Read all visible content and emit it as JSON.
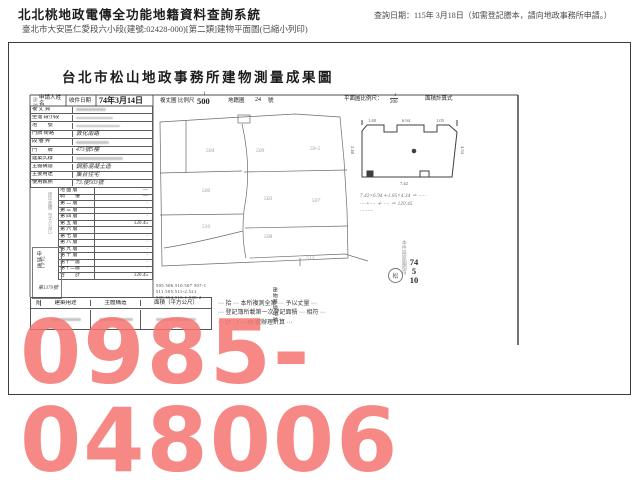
{
  "header": {
    "system_title": "北北桃地政電傳全功能地籍資料查詢系統",
    "query_date": "查詢日期：115年 3月18日（如需登記謄本，請向地政事務所申請。）",
    "doc_line": "臺北市大安區仁愛段六小段(建號:02428-000)[第二類]建物平面圖(已縮小列印)"
  },
  "survey": {
    "title": "台北市松山地政事務所建物測量成果圖",
    "margin_label": "建號",
    "top": {
      "applicant": "申請人姓名",
      "receive": "收件日期",
      "receive_date": "74年3月14日",
      "scale_label": "複丈圖 比例尺",
      "scale_num": "1",
      "scale_den": "500",
      "cadastral": "地籍圖",
      "cadastral_no": "24",
      "cadastral_unit": "號",
      "plan_scale": "平面圖比例尺：",
      "plan_num": "1",
      "plan_den": "200",
      "calc": "面積計算式"
    },
    "info_rows": [
      {
        "label": "複 丈 員",
        "value": ""
      },
      {
        "label": "坐落 段小段",
        "value": ""
      },
      {
        "label": "地　　號",
        "value": ""
      },
      {
        "label": "門牌 街路",
        "value": "敦化南路"
      },
      {
        "label": "段 巷 弄",
        "value": ""
      },
      {
        "label": "門　　牌",
        "value": "473號5樓"
      },
      {
        "label": "建築式樣",
        "value": ""
      },
      {
        "label": "主體構造",
        "value": "鋼筋混凝土造"
      },
      {
        "label": "主要用途",
        "value": "集合住宅"
      },
      {
        "label": "使用執照",
        "value": "73.使503號"
      }
    ],
    "floor_header": "建坪面積（平方公尺）",
    "floors": [
      {
        "label": "地 面 層",
        "value": "—"
      },
      {
        "label": "騎　　樓",
        "value": "—"
      },
      {
        "label": "第 二 層",
        "value": "·"
      },
      {
        "label": "第 三 層",
        "value": "·"
      },
      {
        "label": "第 四 層",
        "value": "·"
      },
      {
        "label": "第 五 層",
        "value": "120.45"
      },
      {
        "label": "第 六 層",
        "value": "·"
      },
      {
        "label": "第 七 層",
        "value": "·"
      },
      {
        "label": "第 八 層",
        "value": "·"
      },
      {
        "label": "第 九 層",
        "value": "·"
      },
      {
        "label": "第 十 層",
        "value": "·"
      },
      {
        "label": "第十一層",
        "value": "·"
      },
      {
        "label": "第十二層",
        "value": "·"
      },
      {
        "label": "合　　計",
        "value": "120.45"
      }
    ],
    "stamp_box": {
      "l1": "申請書",
      "l2": "74.4.1",
      "l3": "第1379號"
    },
    "attachment": {
      "side": "附",
      "cols": [
        "建築用途",
        "主體構造",
        "面積（平方公尺）"
      ]
    },
    "notes": [
      "··· 拾 ··· 本所複測全案 ··· 予以丈量 ···",
      "··· 登記簿所載第一次登記面積 ··· 相符 ···",
      "··· (7　) ··· 09 號辦理計算 ···"
    ],
    "map_labels": [
      "504",
      "509",
      "59-5",
      "506",
      "503",
      "507",
      "510",
      "508",
      "512"
    ],
    "parcel_lines": [
      "505.506.510.507 507-1",
      "511.505.511-2.521",
      "508.504.510-1.508-2"
    ],
    "parcel_side": "建物基地地號",
    "plan_dims": [
      "1.48",
      "6.94",
      "1.05",
      "2.40",
      "4.34",
      "7.42"
    ],
    "calc_lines": [
      "7.42×6.94＋1.05×4.34 ＝ ·····",
      "····×···· ＋ ···· ＝ 120.45",
      "·········"
    ],
    "right_stamp": {
      "vert": "本件與原圖相符",
      "y1": "74",
      "y2": "5",
      "y3": "10",
      "seal": "松"
    }
  },
  "watermark": {
    "text": "0985-048006",
    "color": "#f57370"
  }
}
